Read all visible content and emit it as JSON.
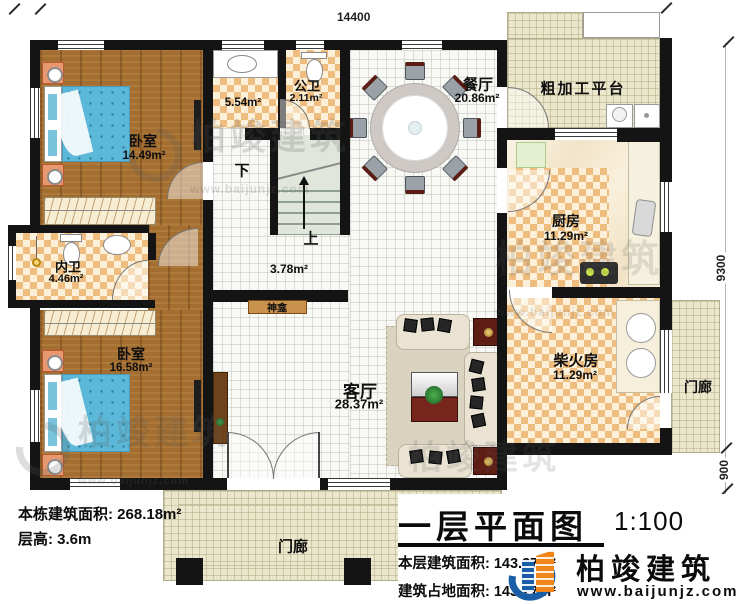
{
  "dimensions": {
    "top": "14400",
    "right_main": "9300",
    "right_porch": "900",
    "right_block": "2000"
  },
  "rooms": {
    "bedroom1": {
      "name": "卧室",
      "area": "14.49m²"
    },
    "washroom": {
      "area": "5.54m²"
    },
    "public_bath": {
      "name": "公卫",
      "area": "2.11m²"
    },
    "dining": {
      "name": "餐厅",
      "area": "20.86m²"
    },
    "platform": {
      "name": "粗加工平台"
    },
    "kitchen": {
      "name": "厨房",
      "area": "11.29m²"
    },
    "inner_bath": {
      "name": "内卫",
      "area": "4.46m²"
    },
    "bedroom2": {
      "name": "卧室",
      "area": "16.58m²"
    },
    "hall": {
      "area": "3.78m²"
    },
    "shrine": {
      "name": "神龛"
    },
    "living": {
      "name": "客厅",
      "area": "28.37m²"
    },
    "firewood": {
      "name": "柴火房",
      "area": "11.29m²"
    },
    "porch_right": {
      "name": "门廊"
    },
    "porch_bottom": {
      "name": "门廊"
    }
  },
  "stairs": {
    "down": "下",
    "up": "上"
  },
  "info_left": {
    "line1": "本栋建筑面积: 268.18m²",
    "line2": "层高: 3.6m"
  },
  "title_block": {
    "title": "一层平面图",
    "scale": "1:100",
    "line1": "本层建筑面积: 143.27m²",
    "line2": "建筑占地面积: 143.27m²"
  },
  "brand": {
    "name": "柏竣建筑",
    "url": "www.baijunjz.com"
  },
  "watermark": {
    "name": "柏竣建筑",
    "url": "www.baijunjz.com"
  },
  "colors": {
    "wall": "#141414",
    "checker_dark": "#eebd7f",
    "checker_light": "#fcf0d8",
    "wood": "#a46e30",
    "bed": "#5cb8d8",
    "tile_beige": "#ebe7cd",
    "stair": "#e0e6db",
    "shrine": "#c9924d",
    "logo_blue": "#1b5ea8",
    "logo_orange": "#f08619"
  }
}
